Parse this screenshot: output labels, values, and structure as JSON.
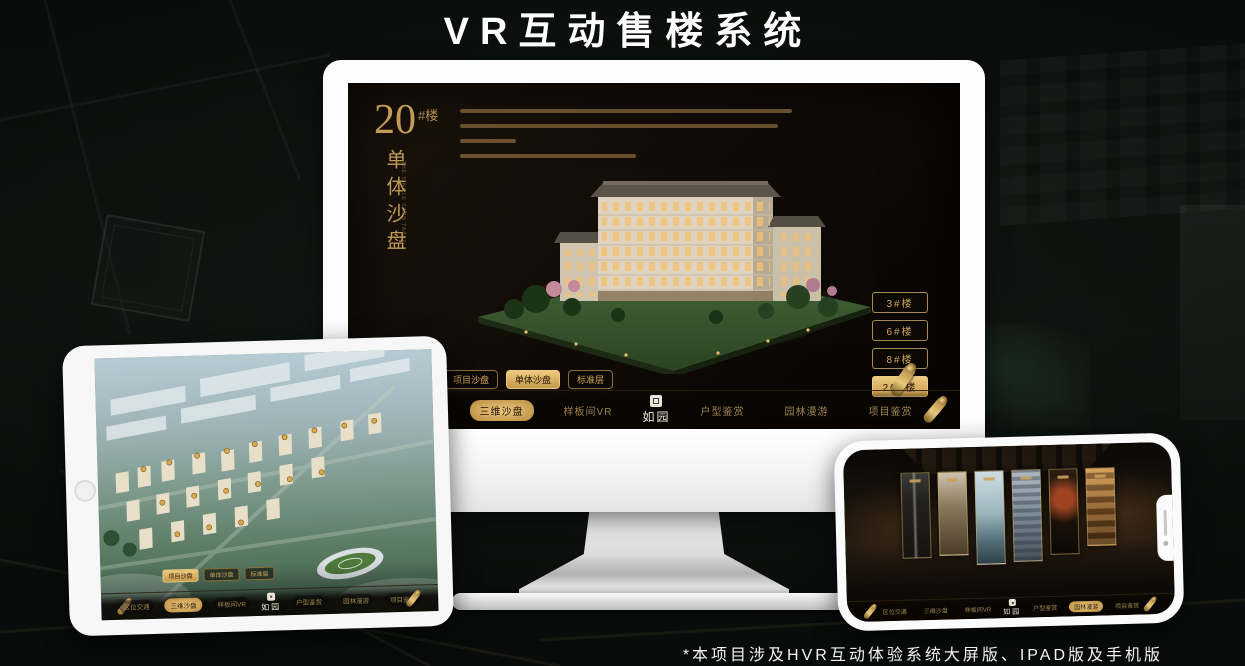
{
  "page": {
    "title": "VR互动售楼系统",
    "footnote": "*本项目涉及HVR互动体验系统大屏版、IPAD版及手机版"
  },
  "colors": {
    "gold": "#c59a55",
    "gold_bright": "#ecc87e",
    "screen_bg": "#14100a",
    "stage_bg": "#0a0d0b"
  },
  "desktop": {
    "block_number": "20",
    "block_unit": "#楼",
    "block_title": "单体沙盘",
    "block_caption": "THE SINGLE SAND TABLE",
    "tabs": [
      {
        "label": "项目沙盘"
      },
      {
        "label": "单体沙盘"
      },
      {
        "label": "标准层"
      }
    ],
    "active_tab": "单体沙盘",
    "floors": [
      {
        "label": "3#楼"
      },
      {
        "label": "6#楼"
      },
      {
        "label": "8#楼"
      },
      {
        "label": "20#楼"
      }
    ],
    "active_floor": "20#楼"
  },
  "menu": {
    "logo": "如园",
    "items": [
      {
        "label": "区位交通"
      },
      {
        "label": "三维沙盘"
      },
      {
        "label": "样板间VR"
      },
      {
        "label": "户型鉴赏"
      },
      {
        "label": "园林漫游"
      },
      {
        "label": "项目鉴赏"
      }
    ]
  },
  "tablet": {
    "active_tab": "项目沙盘",
    "active_menu": "三维沙盘"
  },
  "phone": {
    "active_menu": "园林漫游"
  }
}
